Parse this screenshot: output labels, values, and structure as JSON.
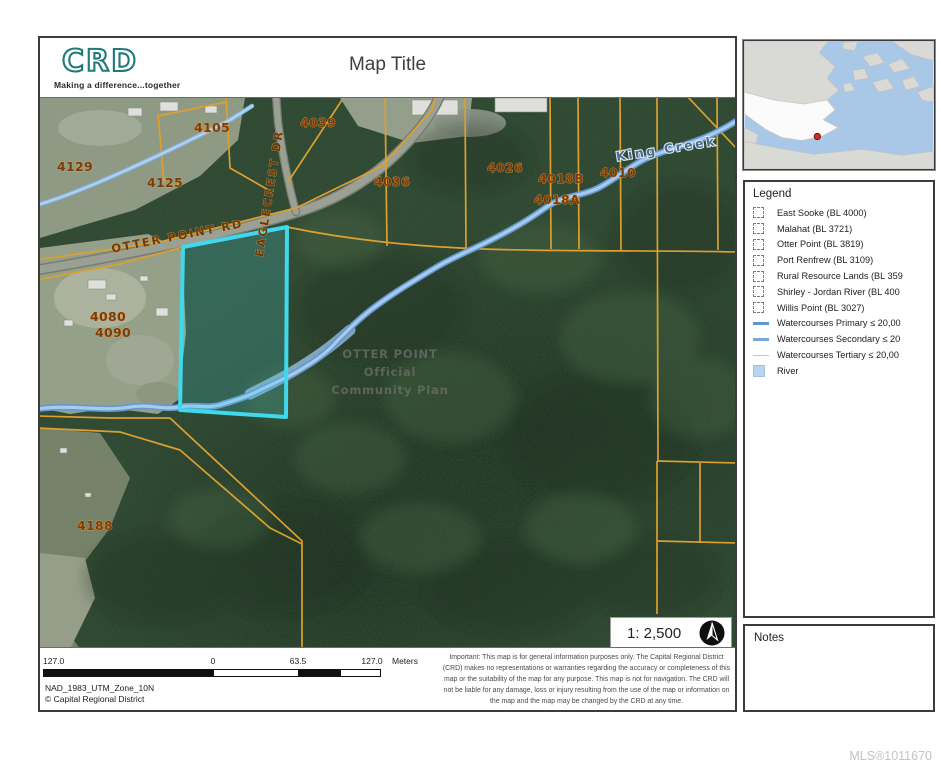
{
  "header": {
    "logo_text": "CRD",
    "logo_tagline": "Making a difference...together",
    "logo_color": "#1d7a78",
    "title": "Map Title"
  },
  "map": {
    "scale_label": "1: 2,500",
    "highlight_color": "#3fd9ee",
    "parcel_line_color": "#dd9f2f",
    "water_color": "#86b7e8",
    "parcel_labels": [
      {
        "text": "4129",
        "x": 35,
        "y": 73
      },
      {
        "text": "4105",
        "x": 172,
        "y": 34
      },
      {
        "text": "4125",
        "x": 125,
        "y": 89
      },
      {
        "text": "4039",
        "x": 278,
        "y": 29
      },
      {
        "text": "4036",
        "x": 352,
        "y": 88
      },
      {
        "text": "4026",
        "x": 465,
        "y": 74
      },
      {
        "text": "4018B",
        "x": 521,
        "y": 85
      },
      {
        "text": "4018A",
        "x": 517,
        "y": 106
      },
      {
        "text": "4010",
        "x": 578,
        "y": 79
      },
      {
        "text": "4080",
        "x": 68,
        "y": 223
      },
      {
        "text": "4090",
        "x": 73,
        "y": 239
      },
      {
        "text": "4188",
        "x": 55,
        "y": 432
      }
    ],
    "road_labels": [
      {
        "text": "OTTER POINT RD",
        "x": 138,
        "y": 142,
        "rotate": -11
      },
      {
        "text": "EAGLECREST DR",
        "x": 233,
        "y": 96,
        "rotate": -81
      }
    ],
    "water_labels": [
      {
        "text": "King Creek",
        "x": 627,
        "y": 55,
        "rotate": -9
      }
    ],
    "overlay_labels": [
      {
        "text": "OTTER POINT",
        "x": 350,
        "y": 260
      },
      {
        "text": "Official",
        "x": 350,
        "y": 278
      },
      {
        "text": "Community Plan",
        "x": 350,
        "y": 296
      }
    ]
  },
  "legend": {
    "title": "Legend",
    "items": [
      {
        "label": "East Sooke (BL 4000)",
        "swatch": "sw-dashed"
      },
      {
        "label": "Malahat (BL 3721)",
        "swatch": "sw-dashed"
      },
      {
        "label": "Otter Point (BL 3819)",
        "swatch": "sw-dashed"
      },
      {
        "label": "Port Renfrew (BL 3109)",
        "swatch": "sw-dashed"
      },
      {
        "label": "Rural Resource Lands (BL 359",
        "swatch": "sw-dashed"
      },
      {
        "label": "Shirley - Jordan River (BL 400",
        "swatch": "sw-dashed"
      },
      {
        "label": "Willis Point (BL 3027)",
        "swatch": "sw-dashed"
      },
      {
        "label": "Watercourses Primary ≤ 20,00",
        "swatch": "sw-line-primary"
      },
      {
        "label": "Watercourses Secondary ≤ 20",
        "swatch": "sw-line-secondary"
      },
      {
        "label": "Watercourses Tertiary ≤ 20,00",
        "swatch": "sw-line-tertiary"
      },
      {
        "label": "River",
        "swatch": "sw-river"
      }
    ]
  },
  "notes": {
    "title": "Notes"
  },
  "footer": {
    "scalebar": {
      "l0": "127.0",
      "l1": "0",
      "l2": "63.5",
      "l3": "127.0",
      "unit": "Meters"
    },
    "projection": "NAD_1983_UTM_Zone_10N",
    "copyright": "© Capital Regional District",
    "disclaimer": "Important: This map is for general information purposes only. The Capital Regional District (CRD) makes no representations or warranties regarding the accuracy or completeness of this map or the suitability of the map for any purpose. This map is not for navigation. The CRD will not be liable for any damage, loss or injury resulting from the use of the map or information on the map and the map may be changed by the CRD at any time."
  },
  "watermark": "MLS®1011670"
}
